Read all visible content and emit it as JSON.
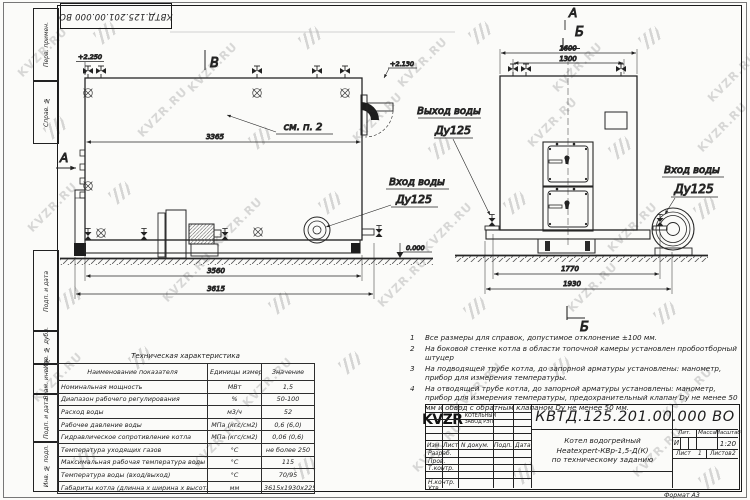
{
  "sheet": {
    "doc_number": "КВТД.125.201.00.000  ВО",
    "format_label": "Формат  А3",
    "watermark": "KVZR.RU"
  },
  "side_strip": {
    "items": [
      "Перв. примен.",
      "Справ. №",
      "Подп. и дата",
      "Инв. № дубл.",
      "Взам. инв. №",
      "Подп. и дата",
      "Инв. № подл."
    ]
  },
  "views": {
    "side": {
      "view_label": "В",
      "section_label": "А",
      "elev_top_left": "+2.250",
      "elev_top_right": "+2.130",
      "elev_zero": "0.000",
      "see_note": "см. п. 2",
      "dim_3365": "3365",
      "dim_3560": "3560",
      "dim_3615": "3615",
      "inlet_label": "Вход воды",
      "inlet_dn": "Ду125"
    },
    "front": {
      "section_a": "А",
      "section_b_top": "Б",
      "section_b_bottom": "Б",
      "dim_1600": "1600",
      "dim_1300": "1300",
      "dim_1770": "1770",
      "dim_1930": "1930",
      "outlet_label": "Выход воды",
      "outlet_dn": "Ду125",
      "inlet_label": "Вход воды",
      "inlet_dn": "Ду125"
    }
  },
  "notes": [
    {
      "n": "1",
      "text": "Все размеры для справок, допустимое отклонение  ±100 мм."
    },
    {
      "n": "2",
      "text": "На боковой стенке котла в области топочной камеры установлен пробоотборный штуцер"
    },
    {
      "n": "3",
      "text": "На  подводящей трубе котла, до запорной арматуры установлены: манометр, прибор для измерения температуры."
    },
    {
      "n": "4",
      "text": "На отводящей трубе котла, до запорной арматуры установлены: манометр, прибор для измерения температуры, предохранительный клапан Dу не менее 50 мм и обвод с обратным клапаном Dу не менее 50 мм."
    }
  ],
  "tech_table": {
    "title": "Техническая характеристика",
    "headers": [
      "Наименование показателя",
      "Единицы измерения",
      "Значение"
    ],
    "rows": [
      [
        "Номинальная мощность",
        "МВт",
        "1,5"
      ],
      [
        "Диапазон рабочего регулирования",
        "%",
        "50-100"
      ],
      [
        "Расход воды",
        "м3/ч",
        "52"
      ],
      [
        "Рабочее давление воды",
        "МПа (кгс/см2)",
        "0,6 (6,0)"
      ],
      [
        "Гидравлическое сопротивление котла",
        "МПа (кгс/см2)",
        "0,06 (0,6)"
      ],
      [
        "Температура уходящих газов",
        "°С",
        "не более 250"
      ],
      [
        "Максимальная рабочая температура воды",
        "°С",
        "115"
      ],
      [
        "Температура воды (вход/выход)",
        "°С",
        "70/95"
      ],
      [
        "Габариты котла (длинна х ширина х высота)",
        "мм",
        "3615х1930х2250"
      ]
    ]
  },
  "title_block": {
    "rev_headers": [
      "Изм",
      "Лист",
      "N докум.",
      "Подп.",
      "Дата"
    ],
    "row_labels": [
      "Разраб.",
      "Пров.",
      "Т.контр.",
      "Н.контр.",
      "Утв."
    ],
    "name_line1": "Котел водогрейный",
    "name_line2": "Heatexpert-КВр-1,5-Д(К)",
    "name_line3": "по техническому заданию",
    "lit_header": "Лит.",
    "mass_header": "Масса",
    "scale_header": "Масштаб",
    "lit_value": "И",
    "scale_value": "1:20",
    "sheet_label": "Лист",
    "sheet_value": "1",
    "sheets_label": "Листов",
    "sheets_value": "2",
    "logo_word": "KVZR",
    "logo_sub1": "КОТЕЛЬНЫЙ",
    "logo_sub2": "ЗАВОД РЭП"
  }
}
